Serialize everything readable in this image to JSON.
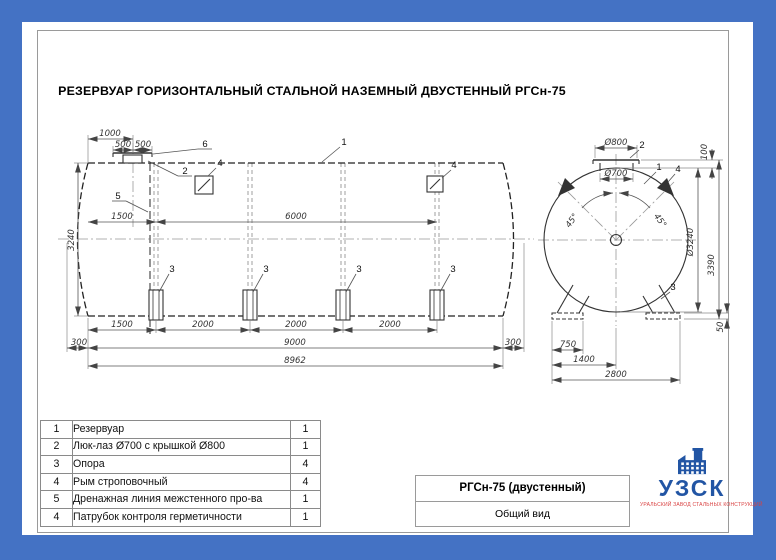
{
  "sheet": {
    "title": "РЕЗЕРВУАР ГОРИЗОНТАЛЬНЫЙ СТАЛЬНОЙ НАЗЕМНЫЙ ДВУСТЕННЫЙ РГСн-75"
  },
  "side_view": {
    "dims": {
      "d1000": "1000",
      "d500": "500",
      "d1500": "1500",
      "d6000": "6000",
      "d3240": "3240",
      "d2000": "2000",
      "d300": "300",
      "d9000": "9000",
      "d8962": "8962"
    },
    "callouts": {
      "tank": "1",
      "hatch": "2",
      "support": "3",
      "nozzle": "4",
      "drain": "5",
      "cover": "6"
    }
  },
  "end_view": {
    "dims": {
      "d800": "Ø800",
      "d700": "Ø700",
      "d100": "100",
      "d3240": "Ø3240",
      "d3390": "3390",
      "d45": "45°",
      "d750": "750",
      "d1400": "1400",
      "d2800": "2800",
      "d50": "50"
    },
    "callouts": {
      "tank": "1",
      "hatch": "2",
      "support": "3",
      "lug": "4"
    }
  },
  "parts_table": {
    "rows": [
      {
        "num": "1",
        "name": "Резервуар",
        "qty": "1"
      },
      {
        "num": "2",
        "name": "Люк-лаз Ø700 с крышкой Ø800",
        "qty": "1"
      },
      {
        "num": "3",
        "name": "Опора",
        "qty": "4"
      },
      {
        "num": "4",
        "name": "Рым строповочный",
        "qty": "4"
      },
      {
        "num": "5",
        "name": "Дренажная линия межстенного про-ва",
        "qty": "1"
      },
      {
        "num": "4",
        "name": "Патрубок контроля герметичности",
        "qty": "1"
      }
    ]
  },
  "title_block": {
    "model": "РГСн-75 (двустенный)",
    "view_name": "Общий вид"
  },
  "logo": {
    "abbr": "УЗСК",
    "subtitle": "УРАЛЬСКИЙ ЗАВОД СТАЛЬНЫХ КОНСТРУКЦИЙ"
  },
  "colors": {
    "border_blue": "#4472c4",
    "logo_blue": "#2255a4",
    "logo_red": "#d94141"
  }
}
